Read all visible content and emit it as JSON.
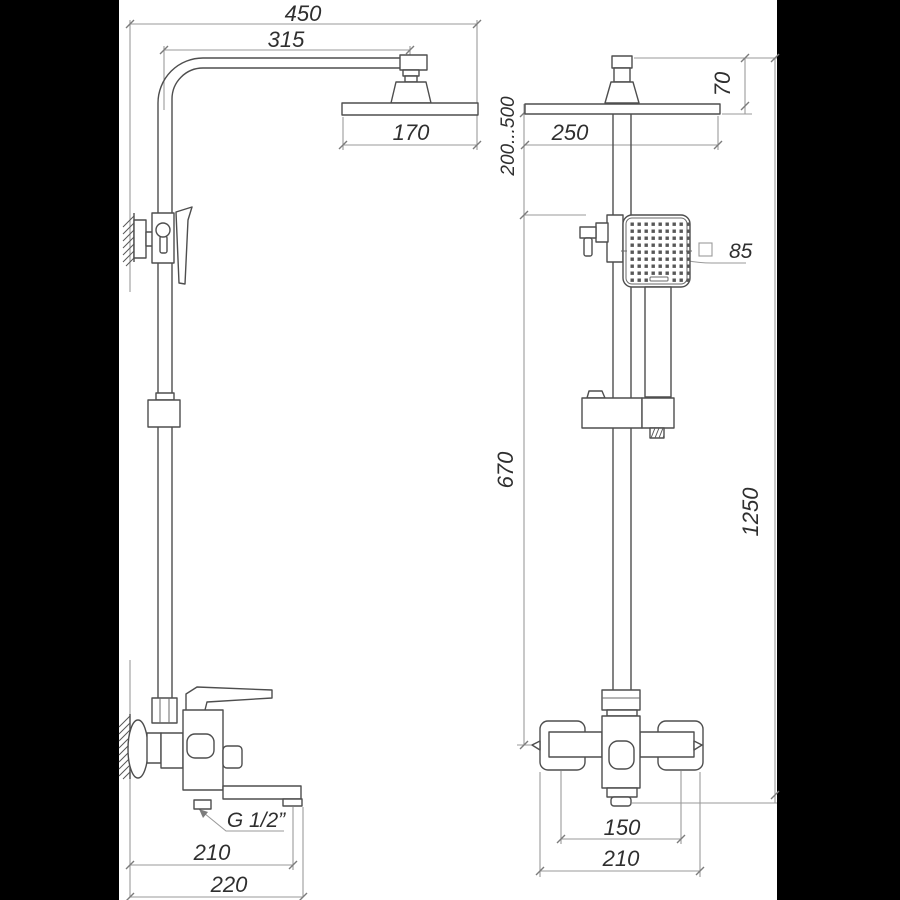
{
  "drawing": {
    "title": "Shower column two-view technical drawing",
    "background_color": "#ffffff",
    "letterbox_color": "#000000",
    "object_line_color": "#4e4e4e",
    "dimension_line_color": "#9a9a9a",
    "text_color": "#2f2f2f"
  },
  "labels": {
    "overall_width": "450",
    "arm_projection": "315",
    "head_depth": "170",
    "spout_reach": "210",
    "overall_depth": "220",
    "thread": "G 1/2”",
    "head_width": "250",
    "head_height": "70",
    "height_range": "200...500",
    "lower_column": "670",
    "overall_height": "1250",
    "handshower_size": "85",
    "outlet_spacing": "150",
    "mixer_width": "210"
  }
}
